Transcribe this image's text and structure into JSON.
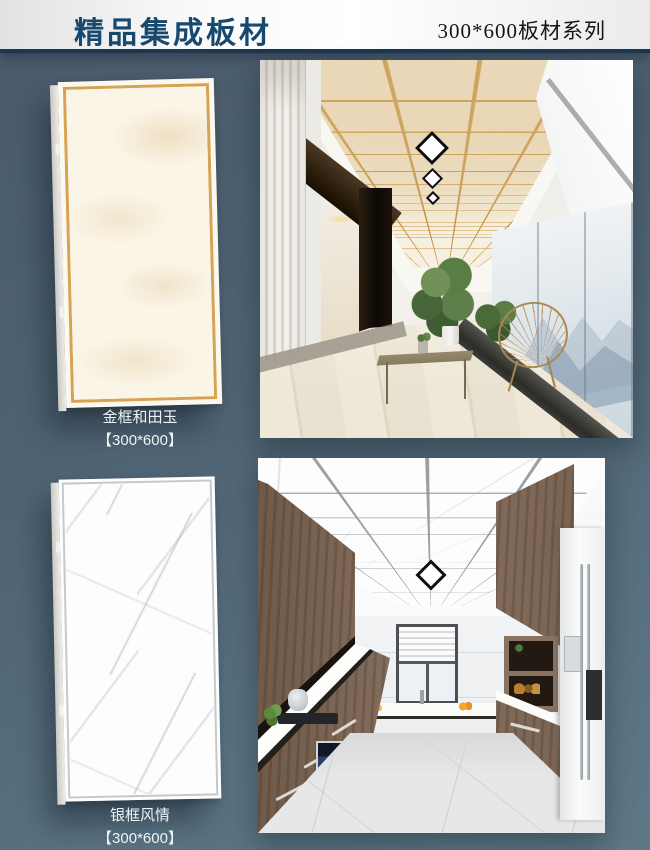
{
  "header": {
    "title": "精品集成板材",
    "series": "300*600板材系列"
  },
  "products": [
    {
      "label": "金框和田玉",
      "size": "【300*600】",
      "frame": "gold",
      "frame_color": "#d7a254"
    },
    {
      "label": "银框风情",
      "size": "【300*600】",
      "frame": "silver",
      "frame_color": "#c4c9cd"
    }
  ],
  "colors": {
    "background": "#4e6272",
    "header_title": "#17486e",
    "header_rule": "#1c3850"
  }
}
